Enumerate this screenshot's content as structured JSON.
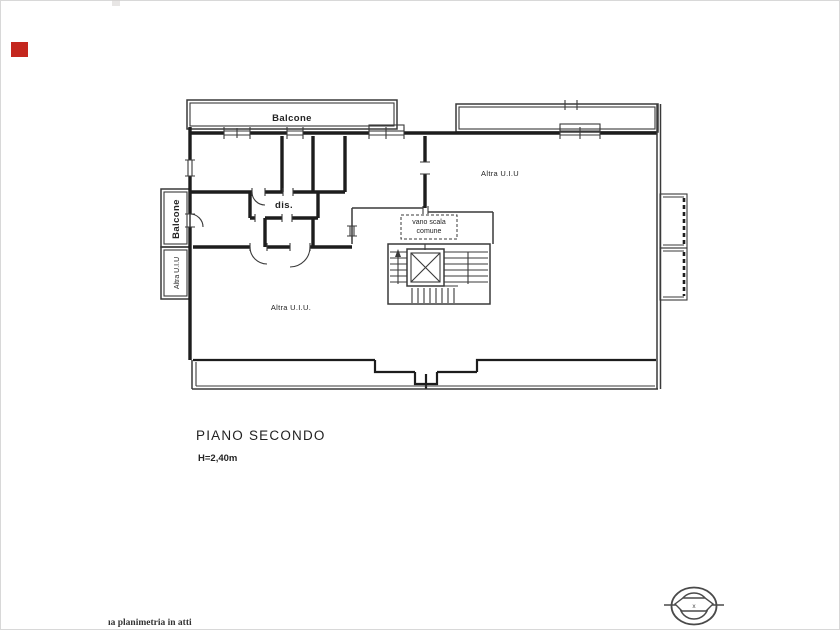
{
  "theme": {
    "background": "#ffffff",
    "line_color": "#3a3a3a",
    "wall_color": "#1d1d1d",
    "marker_red": "#c4271e",
    "stamp_color": "#4a4a4a"
  },
  "plan": {
    "balcony_top_label": "Balcone",
    "balcony_left_label": "Balcone",
    "left_strip_label": "Altra U.I.U",
    "room_right_label": "Altra U.I.U",
    "room_lower_label": "Altra U.I.U.",
    "disimpegno_label": "dis.",
    "stairwell_line1": "vano scala",
    "stairwell_line2": "comune"
  },
  "caption": {
    "floor_title": "PIANO SECONDO",
    "height_note": "H=2,40m"
  },
  "footer": {
    "note": "ıa planimetria in atti"
  },
  "stamp": {
    "mark": "x"
  }
}
